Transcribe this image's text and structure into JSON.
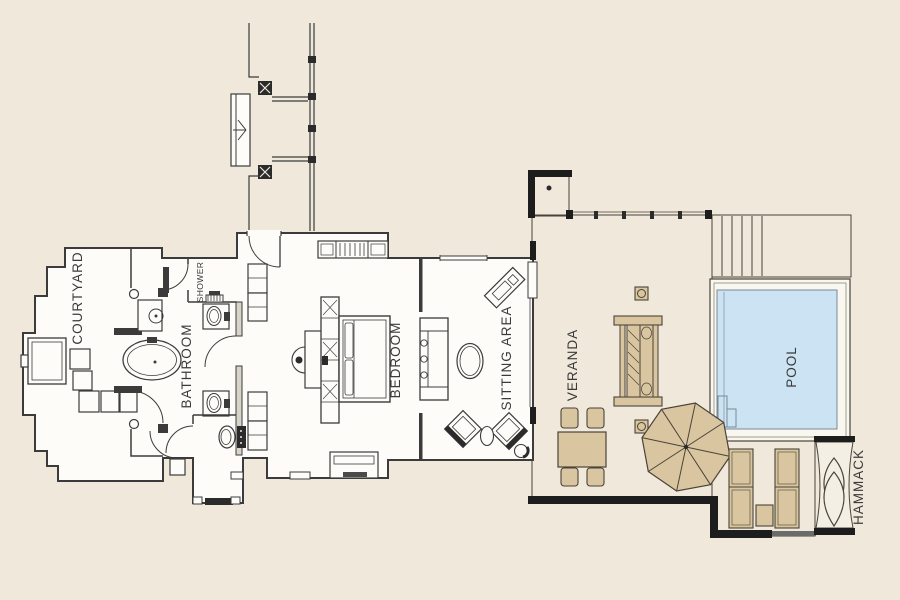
{
  "image_type": "villa floor plan",
  "floor_plan": {
    "rooms": [
      {
        "id": "courtyard",
        "label": "COURTYARD"
      },
      {
        "id": "shower",
        "label": "SHOWER"
      },
      {
        "id": "bathroom",
        "label": "BATHROOM"
      },
      {
        "id": "bedroom",
        "label": "BEDROOM"
      },
      {
        "id": "sitting_area",
        "label": "SITTING AREA"
      },
      {
        "id": "veranda",
        "label": "VERANDA"
      },
      {
        "id": "pool",
        "label": "POOL"
      },
      {
        "id": "hammock",
        "label": "HAMMACK"
      }
    ],
    "colors": {
      "background": "#EFE8DB",
      "floor_white": "#FDFCF9",
      "veranda_tan": "#D9C5A0",
      "pool_blue": "#CBE3F3",
      "pool_frame": "#FAF7F0",
      "hammock_mat": "#F3EFE5",
      "wall_line": "#3B3B3B",
      "deck_edge": "#1D1D1D"
    }
  }
}
